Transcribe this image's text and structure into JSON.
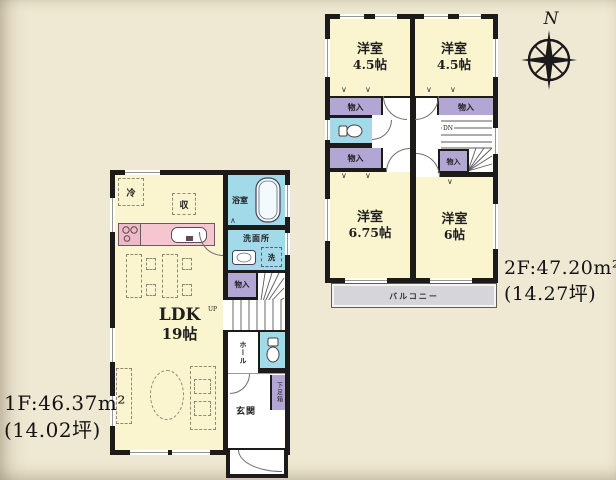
{
  "canvas": {
    "bg": "#efe8d2"
  },
  "colors": {
    "wall": "#1d1b1a",
    "room": "#faf4cf",
    "closet": "#b2a6d4",
    "water": "#a3daea",
    "kitchen": "#f5c6d0",
    "balcony": "#d5d5da",
    "bg": "#efe8d2"
  },
  "compass": {
    "north_label": "N"
  },
  "floor1": {
    "area_label": "1F:46.37m²",
    "tsubo_label": "(14.02坪)",
    "ldk": {
      "name": "LDK",
      "size": "19帖"
    },
    "bath_label": "浴室",
    "washroom_label": "洗面所",
    "laundry_label": "洗",
    "closet_label": "物入",
    "hall_label": "ホール",
    "entrance_label": "玄関",
    "shoebox_label": "下足箱",
    "fridge_label": "冷",
    "storage_label": "収",
    "stairs_label": "UP"
  },
  "floor2": {
    "area_label": "2F:47.20m²",
    "tsubo_label": "(14.27坪)",
    "bedrooms": [
      {
        "name": "洋室",
        "size": "4.5帖"
      },
      {
        "name": "洋室",
        "size": "4.5帖"
      },
      {
        "name": "洋室",
        "size": "6.75帖"
      },
      {
        "name": "洋室",
        "size": "6帖"
      }
    ],
    "closet_labels": [
      "物入",
      "物入",
      "物入",
      "物入"
    ],
    "balcony_label": "バルコニー",
    "stairs_label": "DN"
  }
}
